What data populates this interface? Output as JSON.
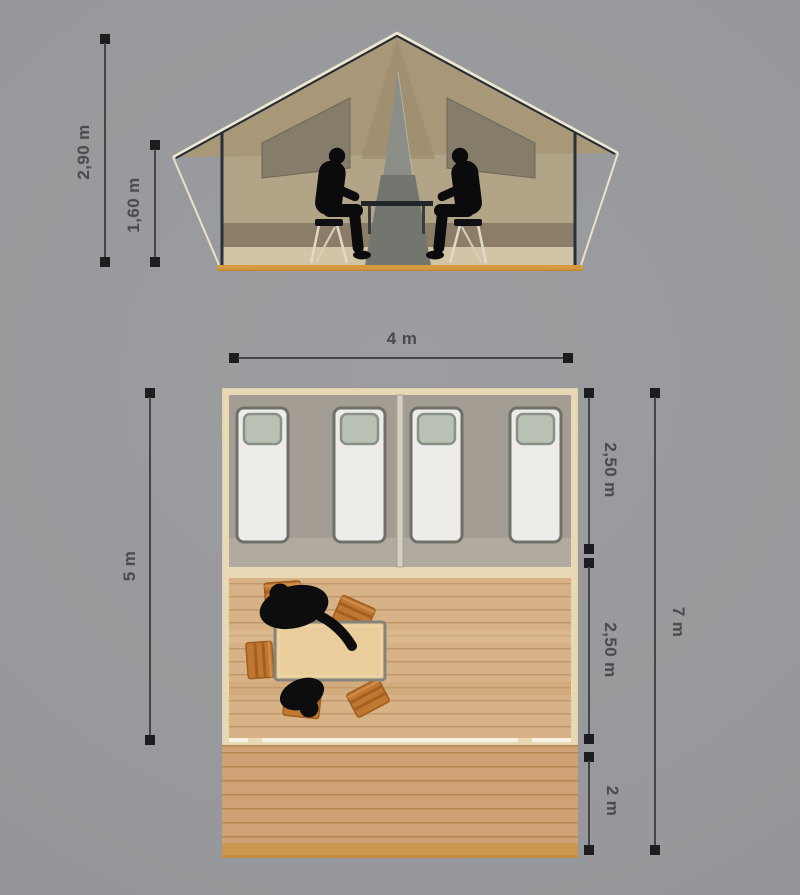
{
  "page": {
    "background_color": "#97989b",
    "description": "Safari tent dimension diagram: front elevation and floor plan"
  },
  "elevation_view": {
    "name": "tent-front-elevation",
    "dimensions": {
      "ridge_height": "2,90 m",
      "wall_height": "1,60 m"
    },
    "colors": {
      "canvas": "#a89878",
      "wall": "#b2a486",
      "window": "#857d6a",
      "door": "#8b8e86",
      "base": "#d5993f",
      "frame": "#27313d",
      "outline": "#efe7cf"
    }
  },
  "plan_view": {
    "name": "tent-floor-plan",
    "beds": 4,
    "bedrooms": 2,
    "dimensions": {
      "width": "4 m",
      "tent_depth": "5 m",
      "sleeping_area_depth": "2,50 m",
      "living_area_depth": "2,50 m",
      "terrace_depth": "2 m",
      "total_depth": "7 m"
    },
    "colors": {
      "frame": "#e9d8b4",
      "sleeping_floor": "#a39d93",
      "living_floor": "#d7b286",
      "terrace_floor": "#cfa276",
      "mattress": "#edece8",
      "pillow": "#b9c1b5",
      "chair": "#c07732",
      "table": "#e9cd9a"
    }
  }
}
